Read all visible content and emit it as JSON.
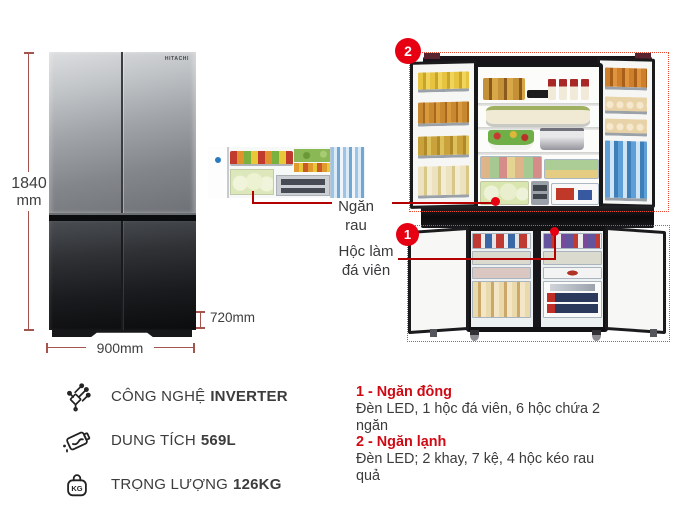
{
  "product": {
    "brand_logo": "HITACHI",
    "dimensions": {
      "height_value": "1840",
      "height_unit": "mm",
      "width_label": "900mm",
      "depth_label": "720mm"
    },
    "callouts": {
      "vegetable_drawer_line1": "Ngăn",
      "vegetable_drawer_line2": "rau",
      "ice_box_line1": "Hộc làm",
      "ice_box_line2": "đá viên",
      "fridge_badge": "2",
      "freezer_badge": "1"
    },
    "features": [
      {
        "icon": "inverter-circuit-icon",
        "label": "CÔNG NGHỆ",
        "value": "INVERTER"
      },
      {
        "icon": "water-capacity-icon",
        "label": "DUNG TÍCH",
        "value": "569L"
      },
      {
        "icon": "kg-weight-icon",
        "icon_text": "KG",
        "label": "TRỌNG LƯỢNG",
        "value": "126KG"
      }
    ],
    "legend": [
      {
        "heading": "1 - Ngăn đông",
        "description": "Đèn LED, 1 hộc đá viên, 6 hộc chứa 2 ngăn"
      },
      {
        "heading": "2 - Ngăn lạnh",
        "description": "Đèn LED; 2 khay, 7 kệ, 4 hộc kéo rau quả"
      }
    ],
    "colors": {
      "accent_red": "#e60012",
      "callout_line_red": "#b30000",
      "dimension_line": "#a3554e",
      "heading_red": "#cf0a14",
      "body_text": "#3c3c3c"
    }
  }
}
